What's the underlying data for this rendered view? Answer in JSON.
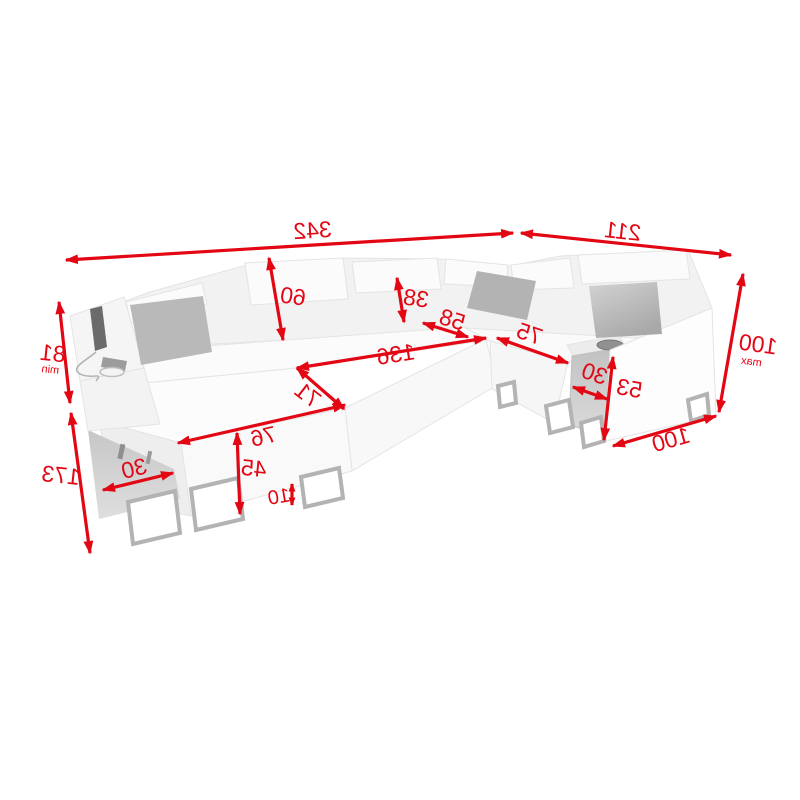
{
  "canvas": {
    "width": 800,
    "height": 800,
    "background": "#ffffff"
  },
  "diagram": {
    "kind": "corner-sofa-dimension-diagram",
    "text_direction": "mirrored-horizontally",
    "accent_color": "#e30613",
    "sofa_colors": {
      "body": "#fafafa",
      "outline": "#e4e4e4",
      "pillow": "#b5b5b5",
      "console_side": "#c6c6c6",
      "storage_shadow": "#d1d1d1",
      "legs": "#b3b3b3",
      "device": "#6b6b6b"
    },
    "labels": {
      "d342": {
        "value": "342"
      },
      "d211": {
        "value": "211"
      },
      "d100max": {
        "value": "100",
        "suffix": "max"
      },
      "d60": {
        "value": "60"
      },
      "d38": {
        "value": "38"
      },
      "d58": {
        "value": "58"
      },
      "d136": {
        "value": "136"
      },
      "d71": {
        "value": "71"
      },
      "d75": {
        "value": "75"
      },
      "d30_right": {
        "value": "30"
      },
      "d53": {
        "value": "53"
      },
      "d100_side": {
        "value": "100"
      },
      "d81min": {
        "value": "81",
        "suffix": "min"
      },
      "d173": {
        "value": "173"
      },
      "d30_left": {
        "value": "30"
      },
      "d76": {
        "value": "76"
      },
      "d45": {
        "value": "45"
      },
      "d10": {
        "value": "10"
      }
    }
  }
}
